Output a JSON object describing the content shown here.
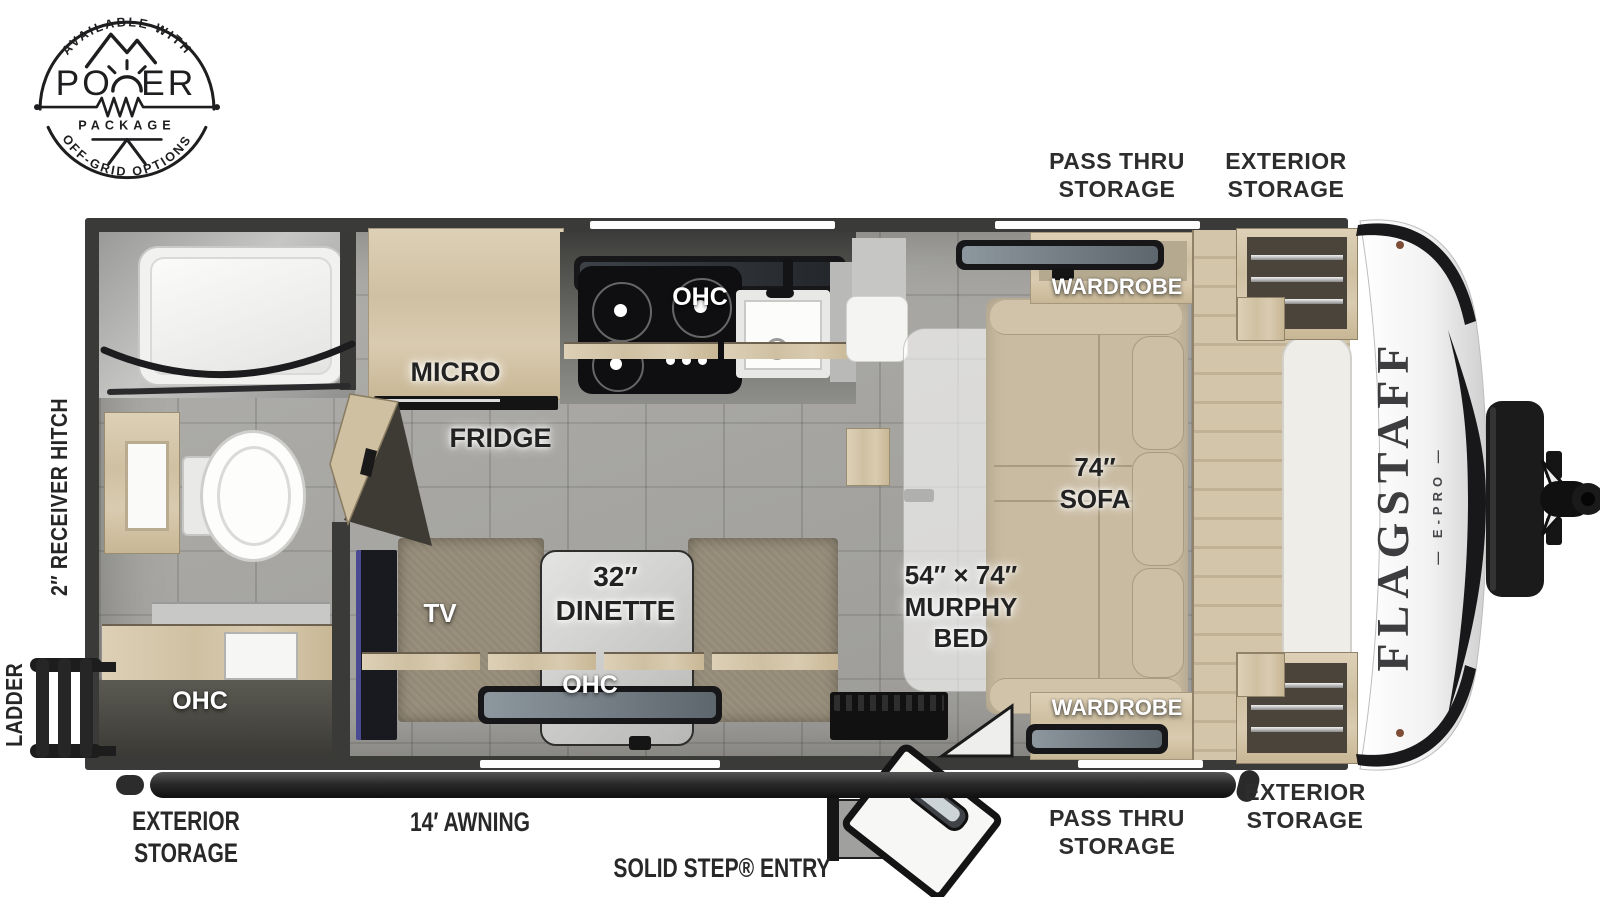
{
  "badge": {
    "top_arc": "AVAILABLE WITH",
    "title": "POWER",
    "title_left": "PO",
    "title_right": "ER",
    "subtitle": "PACKAGE",
    "bottom_arc": "OFF-GRID OPTIONS"
  },
  "model": {
    "name": "FLAGSTAFF",
    "sub": "— E-PRO —"
  },
  "exterior_labels": {
    "pass_thru_top": "PASS THRU\nSTORAGE",
    "exterior_top": "EXTERIOR\nSTORAGE",
    "exterior_bottom_left": "EXTERIOR\nSTORAGE",
    "awning": "14′ AWNING",
    "solid_step": "SOLID STEP® ENTRY",
    "pass_thru_bottom": "PASS THRU\nSTORAGE",
    "exterior_bottom_right": "EXTERIOR\nSTORAGE",
    "receiver_hitch": "2″ RECEIVER HITCH",
    "ladder": "LADDER"
  },
  "interior_labels": {
    "wardrobe_top": "WARDROBE",
    "wardrobe_bottom": "WARDROBE",
    "ohc_kitchen": "OHC",
    "micro": "MICRO",
    "fridge": "FRIDGE",
    "sofa": "74″\nSOFA",
    "murphy_bed": "54″ × 74″\nMURPHY\nBED",
    "dinette": "32″\nDINETTE",
    "tv": "TV",
    "ohc_dinette": "OHC",
    "ohc_bath": "OHC"
  },
  "colors": {
    "wall": "#3a3a38",
    "floor": "#a7a6a2",
    "wood": "#d7c9ad",
    "sofa": "#c9bba1",
    "bench": "#938976",
    "appliance_black": "#17171a",
    "nose_white": "#f4f4f4",
    "label_dark": "#2d2d2d"
  }
}
